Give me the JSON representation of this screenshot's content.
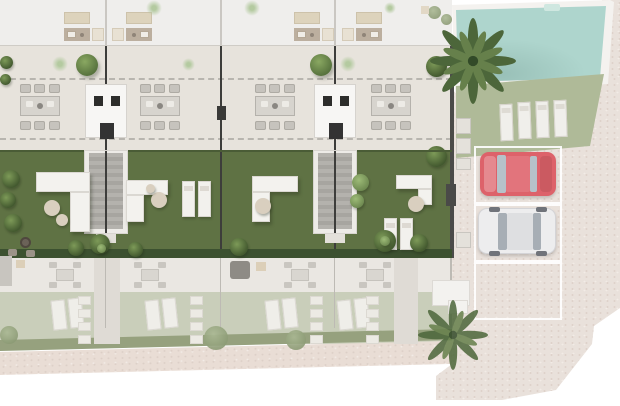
{
  "title": "Residential development site plan (top-down 3D render)",
  "colors": {
    "roof-band": "#efeeec",
    "terrace": "#e7e3dc",
    "garden": "#5f7244",
    "hedge": "#3c5130",
    "hedge-washed": "#96a17e",
    "fence": "#3d3d3b",
    "module": "#f7f6f4",
    "table": "#d7d4ce",
    "chair": "#c6c3bd",
    "sofa": "#f3f2ee",
    "pouf": "#d9cfbf",
    "lounger": "#f2f1ed",
    "pool": "#aed5cd",
    "pool-deck": "#f4f2ef",
    "lawn2": "#afba98",
    "pavement": "#e9e1db",
    "sidewalk": "#e9ddd5",
    "fterrace": "#eae7e2",
    "flawn": "#c9ceba",
    "walkway": "#dfdbd5",
    "car-red": "#dd626a",
    "car-white": "#ededee",
    "dash": "#b8b5af",
    "palm-dark": "#4c663a",
    "palm-light": "#66804b",
    "bush-light": "#7d9a58",
    "bush-dark": "#43592f"
  },
  "site": {
    "townhouse_units_visible": 4,
    "per_unit": {
      "roof_terrace": [
        "outdoor sofa",
        "kitchen counter with sink",
        "side table"
      ],
      "main_terrace": {
        "dining_tables": 1,
        "chairs_per_table": 6
      },
      "garden": [
        "L-shaped sofa",
        "round poufs",
        "sun loungers",
        "bushes"
      ],
      "lower_level_faded": [
        "patio dining set with 4 chairs",
        "2 sun loungers",
        "stepping stones"
      ]
    },
    "shared_features": {
      "staircases_to_garden": 2,
      "entry_modules_with_door_mats": 2,
      "swimming_pool": {
        "location": "top-right",
        "steps": 1
      },
      "poolside_loungers": 4,
      "parking": {
        "spaces": 3,
        "occupied": 2,
        "cars": [
          "red",
          "white"
        ]
      },
      "palm_trees": 2
    }
  }
}
